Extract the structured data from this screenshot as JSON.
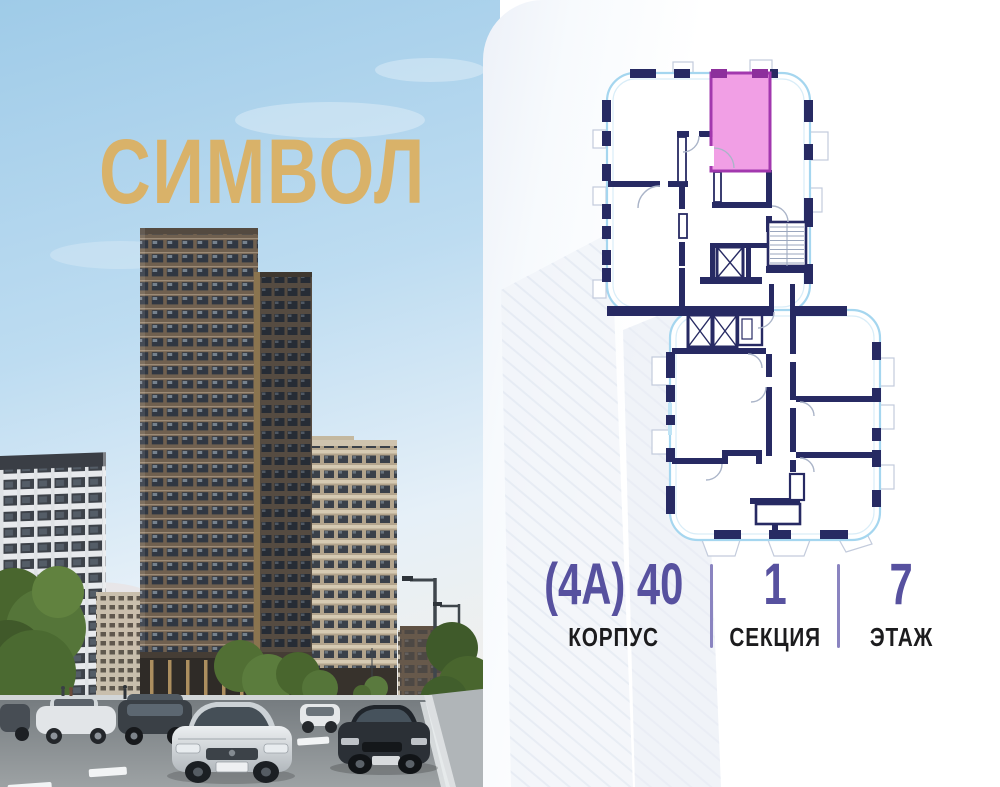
{
  "brand": {
    "logo_text": "СИМВОЛ",
    "logo_color": "#d9b269"
  },
  "media": {
    "left_image": "residential-towers-street-render"
  },
  "floor_plan": {
    "semantic": "floor-plan-with-highlighted-apartment",
    "highlighted_unit": "selected-apartment",
    "colors": {
      "unit_pink": "#f09ae4",
      "unit_border": "#a238ae",
      "wall_navy": "#272a63",
      "outline_blue": "#a5d6ef"
    }
  },
  "details": {
    "items": [
      {
        "value": "(4А) 40",
        "label": "КОРПУС"
      },
      {
        "value": "1",
        "label": "СЕКЦИЯ"
      },
      {
        "value": "7",
        "label": "ЭТАЖ"
      }
    ],
    "value_color": "#57519f",
    "label_color": "#1c1c1e",
    "divider_color": "#8a84c0"
  },
  "palette": {
    "sky_blue": "#a3cfe9",
    "card_white": "#ffffff"
  }
}
